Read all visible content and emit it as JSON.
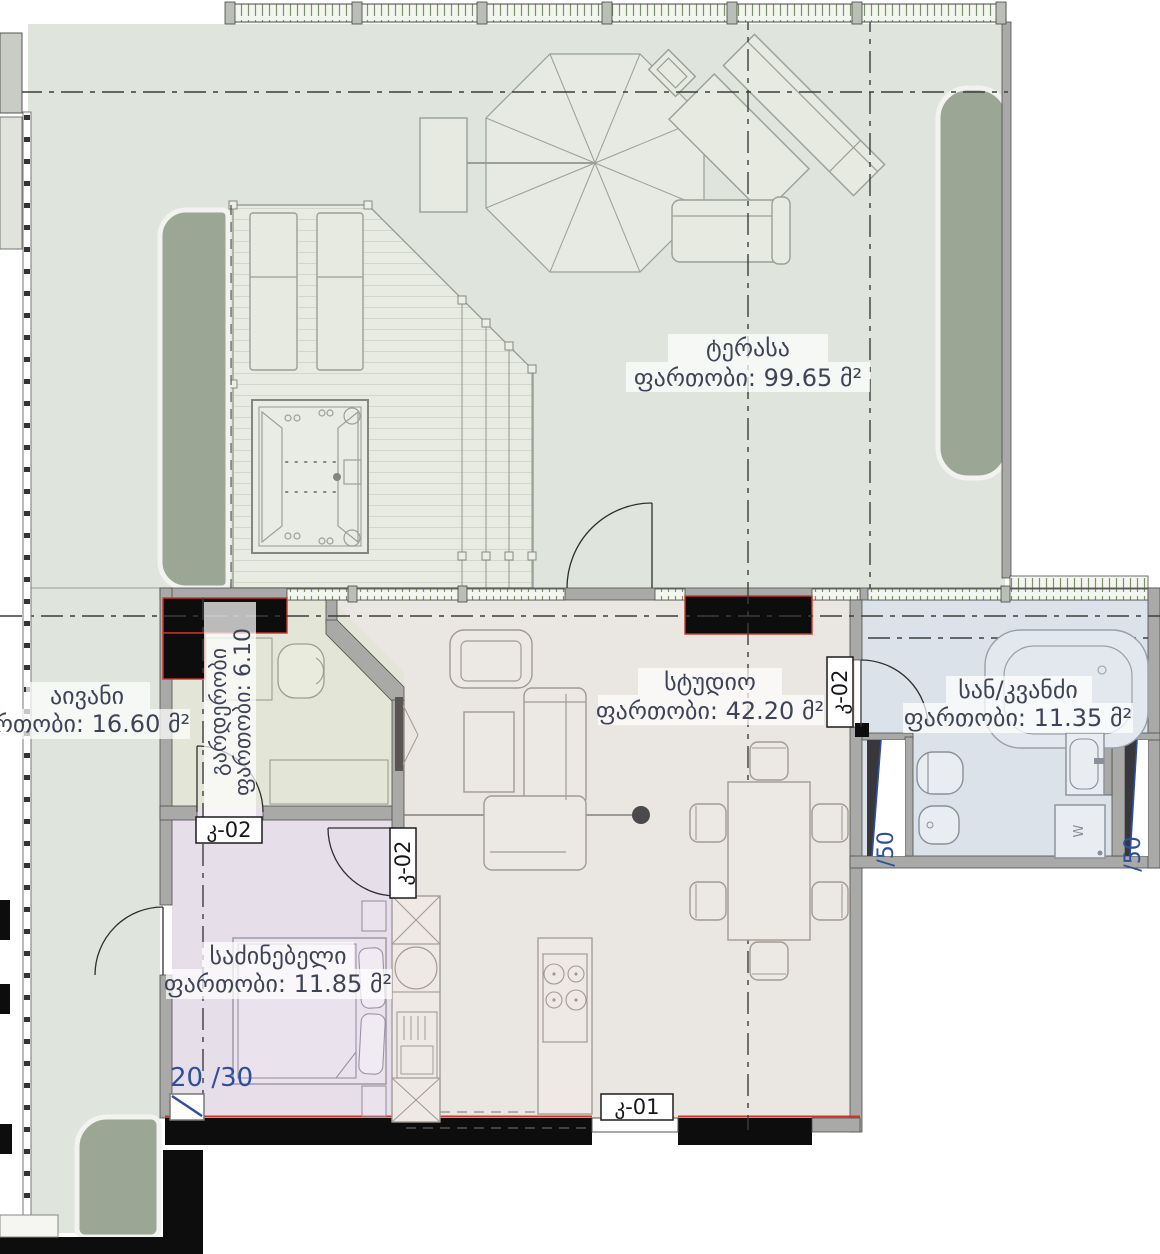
{
  "plan_title": "apartment floor plan",
  "colors": {
    "terrace": "#dfe4dc",
    "deck": "#e8ebe2",
    "studio": "#eae6e2",
    "bedroom": "#e6dfe9",
    "wardrobe": "#e3e6d7",
    "bathroom": "#dbe2ea",
    "planter": "#9ca694",
    "wall": "#a9aaa7",
    "column": "#0d0d0d",
    "red": "#cf3527",
    "blue": "#2d4f9e",
    "label": "#3f4357",
    "glazing": "#7d9069"
  },
  "rooms": [
    {
      "id": "terrace",
      "name": "ტერასა",
      "area": "ფართობი: 99.65 მ²"
    },
    {
      "id": "studio",
      "name": "სტუდიო",
      "area": "ფართობი: 42.20 მ²"
    },
    {
      "id": "bathroom",
      "name": "სან/კვანძი",
      "area": "ფართობი: 11.35 მ²"
    },
    {
      "id": "balcony",
      "name": "აივანი",
      "area": "ფართობი: 16.60 მ²"
    },
    {
      "id": "bedroom",
      "name": "საძინებელი",
      "area": "ფართობი: 11.85 მ²"
    },
    {
      "id": "wardrobe",
      "name": "გარდერობი",
      "area": "ფართობი: 6.10"
    }
  ],
  "door_tags": [
    {
      "id": "wardrobe-door",
      "label": "კ-02"
    },
    {
      "id": "bedroom-door",
      "label": "კ-02"
    },
    {
      "id": "bathroom-door",
      "label": "კ-02"
    },
    {
      "id": "entrance-door",
      "label": "კ-01"
    }
  ],
  "dimensions": {
    "bedroom_window": "20 /30",
    "shaft_left": "/50",
    "shaft_right": "/50"
  },
  "appliances": {
    "washer_label": "W"
  }
}
